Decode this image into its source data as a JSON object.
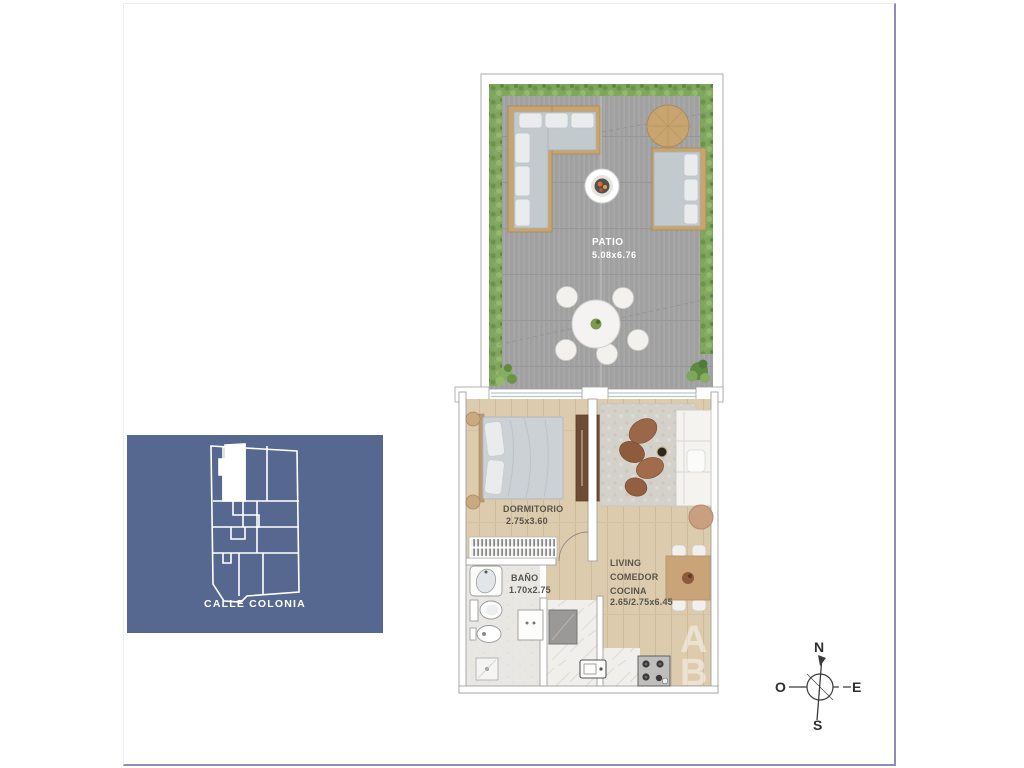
{
  "rooms": {
    "patio": {
      "label": "PATIO",
      "dims": "5.08x6.76"
    },
    "dormitorio": {
      "label": "DORMITORIO",
      "dims": "2.75x3.60"
    },
    "bano": {
      "label": "BAÑO",
      "dims": "1.70x2.75"
    },
    "living": {
      "line1": "LIVING",
      "line2": "COMEDOR",
      "line3": "COCINA",
      "dims": "2.65/2.75x6.45"
    }
  },
  "keyplan": {
    "street_label": "CALLE COLONIA",
    "background": "#56688f"
  },
  "compass": {
    "north": "N",
    "east": "E",
    "south": "S",
    "west": "O"
  },
  "watermark": {
    "line1": "AR",
    "line2": "BE"
  },
  "palette": {
    "deck": "#a0a0a0",
    "hedge": "#7fa65e",
    "wood_floor": "#ddcbae",
    "tile": "#e8e7e3",
    "marble": "#f0efec",
    "rug": "#d4d1cb",
    "sofa_gray": "#c3cacd",
    "cushion_white": "#e9ebed",
    "wood_furniture": "#c8a46f",
    "brown_chair": "#9a6848",
    "wall_stroke": "#a0a0a0",
    "accent_frame": "#8f8bbf",
    "label_gray": "#57544e"
  }
}
